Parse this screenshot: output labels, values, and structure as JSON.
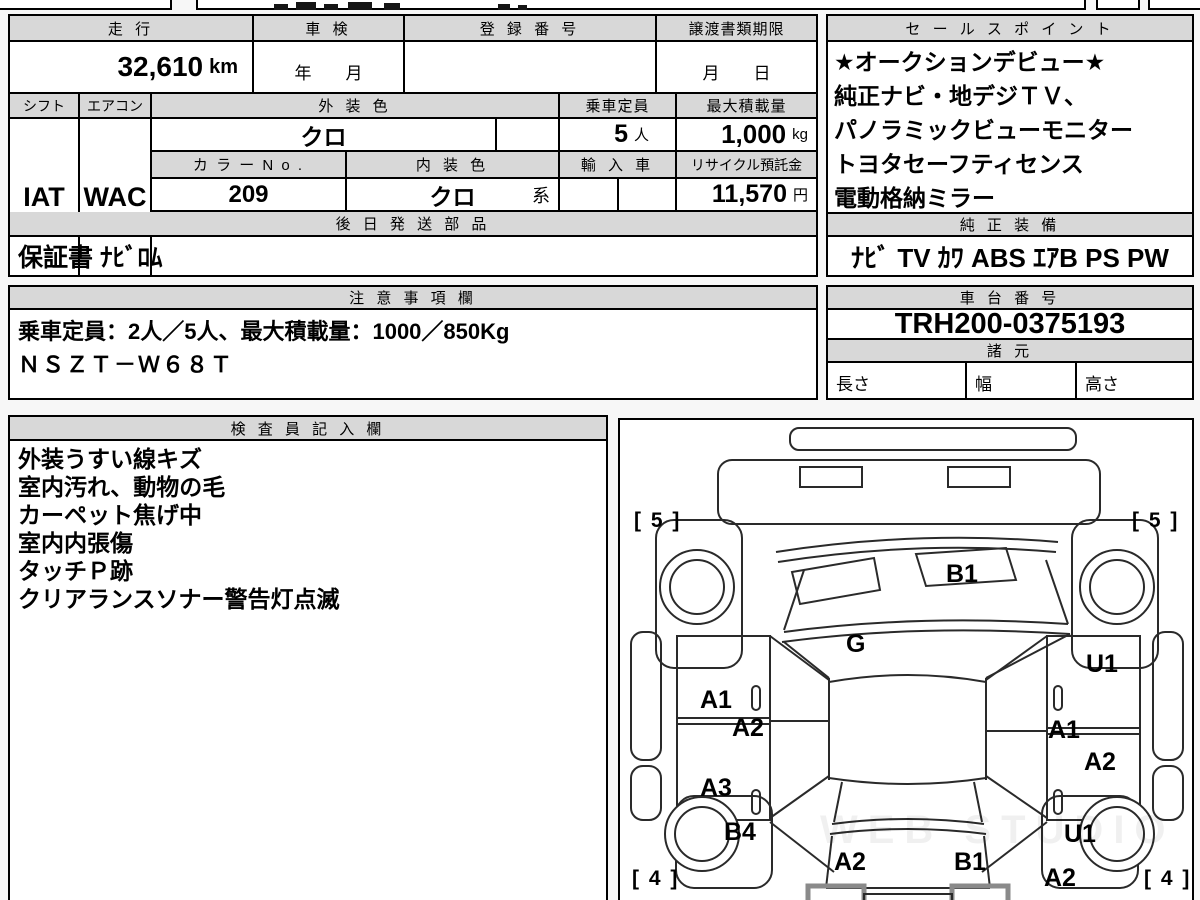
{
  "colors": {
    "header_bg": "#d8d8d8",
    "border": "#000000",
    "page_bg": "#f7f7f7"
  },
  "top_table": {
    "mileage_label": "走 行",
    "mileage_value": "32,610",
    "mileage_unit": "km",
    "inspection_label": "車 検",
    "inspection_value": "年　　月",
    "registration_label": "登 録 番 号",
    "registration_value": "",
    "transfer_label": "譲渡書類期限",
    "transfer_value": "月　　日",
    "shift_label": "シフト",
    "shift_value": "IAT",
    "aircon_label": "エアコン",
    "aircon_value": "WAC",
    "exterior_label": "外 装 色",
    "exterior_value": "クロ",
    "capacity_label": "乗車定員",
    "capacity_value": "5",
    "capacity_unit": "人",
    "maxload_label": "最大積載量",
    "maxload_value": "1,000",
    "maxload_unit": "kg",
    "colorno_label": "カ ラ ー N o .",
    "colorno_value": "209",
    "interior_label": "内 装 色",
    "interior_value": "クロ",
    "interior_suffix": "系",
    "import_label": "輸 入 車",
    "recycle_label": "リサイクル預託金",
    "recycle_value": "11,570",
    "recycle_unit": "円",
    "later_parts_label": "後 日 発 送 部 品",
    "later_parts_value": "保証書 ﾅﾋﾞﾛﾑ"
  },
  "sales": {
    "title": "セ ー ル ス ポ イ ン ト",
    "lines": [
      "★オークションデビュー★",
      "純正ナビ・地デジＴＶ、",
      "パノラミックビューモニター",
      "トヨタセーフティセンス",
      "電動格納ミラー"
    ]
  },
  "equipment": {
    "title": "純 正 装 備",
    "value": "ﾅﾋﾞ TV ｶﾜ ABS ｴｱB PS PW"
  },
  "notes": {
    "title": "注 意 事 項 欄",
    "line1": "乗車定員：2人／5人、最大積載量：1000／850Kg",
    "line2": "ＮＳＺＴ－Ｗ６８Ｔ"
  },
  "chassis": {
    "title": "車 台 番 号",
    "value": "TRH200-0375193"
  },
  "specs": {
    "title": "諸 元",
    "length": "長さ",
    "width": "幅",
    "height": "高さ"
  },
  "inspector": {
    "title": "検 査 員 記 入 欄",
    "lines": [
      "外装うすい線キズ",
      "室内汚れ、動物の毛",
      "カーペット焦げ中",
      "室内内張傷",
      "タッチＰ跡",
      "クリアランスソナー警告灯点滅"
    ]
  },
  "diagram": {
    "front_left_tire": "[ 5 ]",
    "front_right_tire": "[ 5 ]",
    "rear_left_tire": "[ 4 ]",
    "rear_right_tire": "[ 4 ]",
    "labels": [
      "B1",
      "G",
      "U1",
      "A1",
      "A2",
      "A1",
      "A2",
      "A3",
      "B4",
      "U1",
      "A2",
      "B1",
      "A2"
    ],
    "watermark": "WEB STUDIO"
  }
}
